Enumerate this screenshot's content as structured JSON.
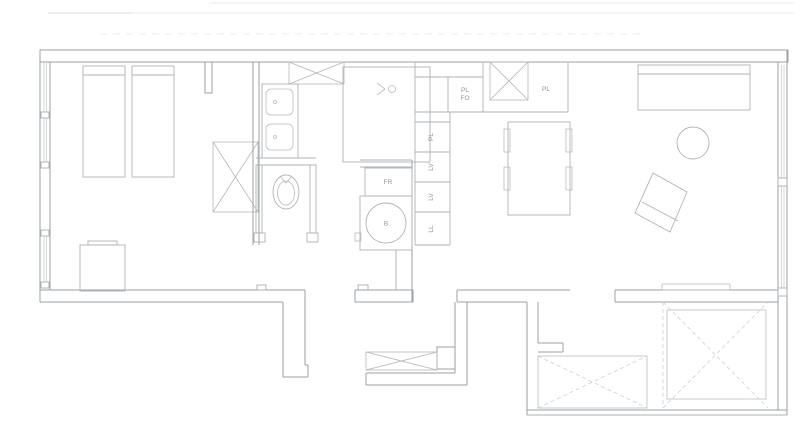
{
  "labels": {
    "oven_unit": {
      "line1": "PL",
      "line2": "FO"
    },
    "wall_cabinet": "PL",
    "kitchen_column": [
      {
        "label": "PL"
      },
      {
        "label": "LV"
      },
      {
        "label": "LV"
      },
      {
        "label": "LL"
      }
    ],
    "fridge_unit": "FR",
    "water_heater": "B"
  },
  "colors": {
    "background": "#ffffff",
    "wall_line": "#9aa0a5",
    "furniture_line": "#aeb3b7",
    "fixture_line": "#b6bbbf",
    "dashed_line": "#ccd0d2",
    "faint_roof_line": "#e9ebec",
    "label_text": "#8e9499"
  }
}
